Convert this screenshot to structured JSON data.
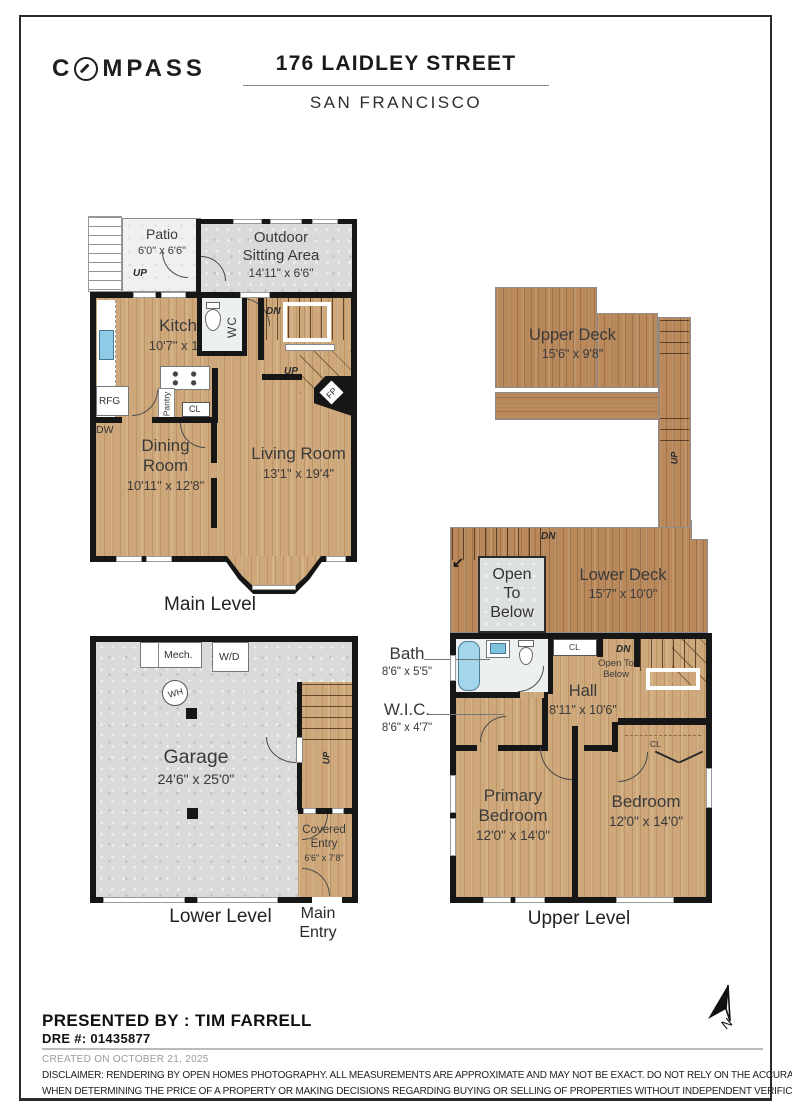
{
  "header": {
    "brand_c": "C",
    "brand_rest": "MPASS",
    "title": "176 LAIDLEY STREET",
    "subtitle": "SAN FRANCISCO"
  },
  "levels": {
    "main": "Main Level",
    "upper": "Upper Level",
    "lower": "Lower Level"
  },
  "rooms": {
    "patio": {
      "name": "Patio",
      "dims": "6'0\" x 6'6\""
    },
    "outdoor_sitting": {
      "name": "Outdoor Sitting Area",
      "dims": "14'11\" x 6'6\""
    },
    "kitchen": {
      "name": "Kitchen",
      "dims": "10'7\" x 11'10\""
    },
    "dining": {
      "name": "Dining Room",
      "dims": "10'11\" x 12'8\""
    },
    "living": {
      "name": "Living Room",
      "dims": "13'1\" x 19'4\""
    },
    "upper_deck": {
      "name": "Upper Deck",
      "dims": "15'6\" x 9'8\""
    },
    "lower_deck": {
      "name": "Lower Deck",
      "dims": "15'7\" x 10'0\""
    },
    "open_to_below": {
      "name": "Open To Below"
    },
    "bath": {
      "name": "Bath",
      "dims": "8'6\" x 5'5\""
    },
    "wic": {
      "name": "W.I.C.",
      "dims": "8'6\" x 4'7\""
    },
    "hall": {
      "name": "Hall",
      "dims": "8'11\" x 10'6\""
    },
    "primary_bedroom": {
      "name": "Primary Bedroom",
      "dims": "12'0\" x 14'0\""
    },
    "bedroom": {
      "name": "Bedroom",
      "dims": "12'0\" x 14'0\""
    },
    "garage": {
      "name": "Garage",
      "dims": "24'6\" x 25'0\""
    },
    "covered_entry": {
      "name": "Covered Entry",
      "dims": "6'6\" x 7'8\""
    },
    "main_entry": {
      "name": "Main Entry"
    }
  },
  "tags": {
    "up": "UP",
    "dn": "DN",
    "wc": "WC",
    "fp": "FP",
    "cl": "CL",
    "pantry": "Pantry",
    "rfg": "RFG",
    "dw": "DW",
    "mech": "Mech.",
    "wd": "W/D",
    "wh": "WH"
  },
  "footer": {
    "presented_by": "PRESENTED BY : TIM FARRELL",
    "dre": "DRE #: 01435877",
    "created": "CREATED ON OCTOBER 21, 2025",
    "disclaimer_1": "DISCLAIMER: RENDERING BY OPEN HOMES PHOTOGRAPHY. ALL MEASUREMENTS ARE APPROXIMATE AND MAY NOT BE EXACT. DO NOT RELY ON THE ACCURACY OF THIS FLOOR PLAN",
    "disclaimer_2": "WHEN DETERMINING THE PRICE OF A PROPERTY OR MAKING DECISIONS REGARDING BUYING OR SELLING OF PROPERTIES WITHOUT INDEPENDENT VERIFICATION.",
    "north": "N"
  },
  "palette": {
    "wood_floor": "#cea87a",
    "deck_wood": "#b9895c",
    "concrete": "#d8dbd7",
    "tub_blue": "#a3d6ec",
    "wall_black": "#161616"
  }
}
